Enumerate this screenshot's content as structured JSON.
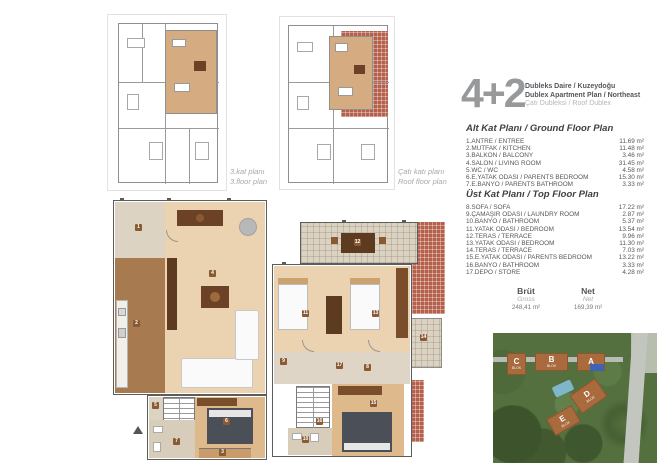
{
  "header": {
    "type_label": "4+2",
    "line1": "Dubleks Daire / Kuzeydoğu",
    "line2": "Dublex Apartment Plan / Northeast",
    "line3": "Çatı Dubleksi / Roof Dublex"
  },
  "thumb_labels": {
    "floor3": {
      "line1": "3.kat planı",
      "line2": "3.floor plan"
    },
    "roof": {
      "line1": "Çatı katı planı",
      "line2": "Roof floor plan"
    }
  },
  "ground_floor": {
    "title": "Alt Kat Planı / Ground Floor Plan",
    "items": [
      {
        "label": "1.ANTRE / ENTREE",
        "area": "11.69 m²"
      },
      {
        "label": "2.MUTFAK / KITCHEN",
        "area": "11.48 m²"
      },
      {
        "label": "3.BALKON / BALCONY",
        "area": "3.46 m²"
      },
      {
        "label": "4.SALON / LIVING ROOM",
        "area": "31.45 m²"
      },
      {
        "label": "5.WC / WC",
        "area": "4.58 m²"
      },
      {
        "label": "6.E.YATAK ODASI / PARENTS BEDROOM",
        "area": "15.30 m²"
      },
      {
        "label": "7.E.BANYO / PARENTS BATHROOM",
        "area": "3.33 m²"
      }
    ]
  },
  "top_floor": {
    "title": "Üst Kat Planı / Top Floor Plan",
    "items": [
      {
        "label": "8.SOFA / SOFA",
        "area": "17.22 m²"
      },
      {
        "label": "9.ÇAMAŞIR ODASI / LAUNDRY ROOM",
        "area": "2.87 m²"
      },
      {
        "label": "10.BANYO / BATHROOM",
        "area": "5.37 m²"
      },
      {
        "label": "11.YATAK ODASI / BEDROOM",
        "area": "13.54 m²"
      },
      {
        "label": "12.TERAS / TERRACE",
        "area": "9.96 m²"
      },
      {
        "label": "13.YATAK ODASI / BEDROOM",
        "area": "11.30 m²"
      },
      {
        "label": "14.TERAS / TERRACE",
        "area": "7.03 m²"
      },
      {
        "label": "15.E.YATAK ODASI / PARENTS BEDROOM",
        "area": "13.22 m²"
      },
      {
        "label": "16.BANYO / BATHROOM",
        "area": "3.33 m²"
      },
      {
        "label": "17.DEPO / STORE",
        "area": "4.28 m²"
      }
    ]
  },
  "totals": {
    "gross_label": "Brüt",
    "gross_sub": "Gross",
    "gross_value": "248,41 m²",
    "net_label": "Net",
    "net_sub": "Net",
    "net_value": "169,39 m²"
  },
  "site": {
    "block_a": "A",
    "block_b": "B",
    "block_c": "C",
    "block_d": "D",
    "block_e": "E",
    "sub": "BLOK"
  },
  "badges": {
    "g1": "1",
    "g2": "2",
    "g3": "3",
    "g4": "4",
    "g5": "5",
    "g6": "6",
    "g7": "7",
    "t8": "8",
    "t9": "9",
    "t10": "10",
    "t11": "11",
    "t12": "12",
    "t13": "13",
    "t14": "14",
    "t15": "15",
    "t16": "16",
    "t17": "17"
  },
  "colors": {
    "tan_highlight": "#d5ac82",
    "brick": "#b5604a",
    "wood_light": "#ebd3b1",
    "wood_mid": "#ddb98c",
    "kitchen_brown": "#a87a50",
    "furniture_brown": "#6b4226",
    "bed_gray": "#4b4f57",
    "text_dark": "#55565a",
    "heading_gray": "#97999b",
    "site_green": "#55703f",
    "block_orange": "#a96b3e",
    "highlight_blue": "#3f62b5"
  }
}
